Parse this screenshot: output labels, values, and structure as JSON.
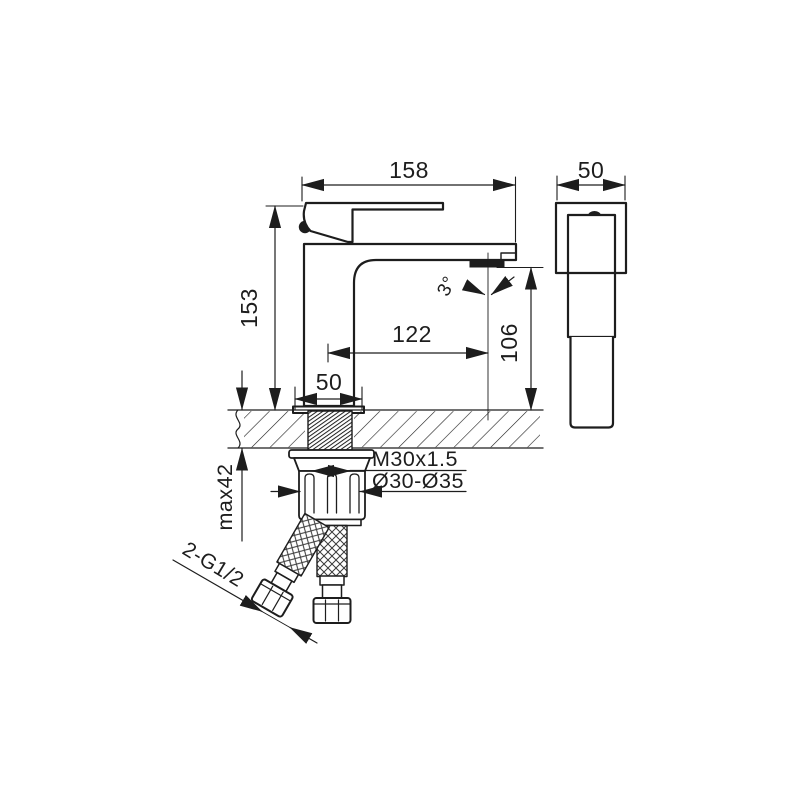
{
  "drawing": {
    "dimensions": {
      "overall_width": "158",
      "total_height": "153",
      "spout_reach": "122",
      "outlet_height": "106",
      "spray_angle": "3°",
      "base_width": "50",
      "side_width": "50",
      "max_deck_thickness": "max42",
      "shank_thread": "M30x1.5",
      "hole_diameter": "Ø30-Ø35",
      "hose_connections": "2-G1/2"
    },
    "colors": {
      "line": "#1d1d1d",
      "background": "#ffffff"
    }
  }
}
